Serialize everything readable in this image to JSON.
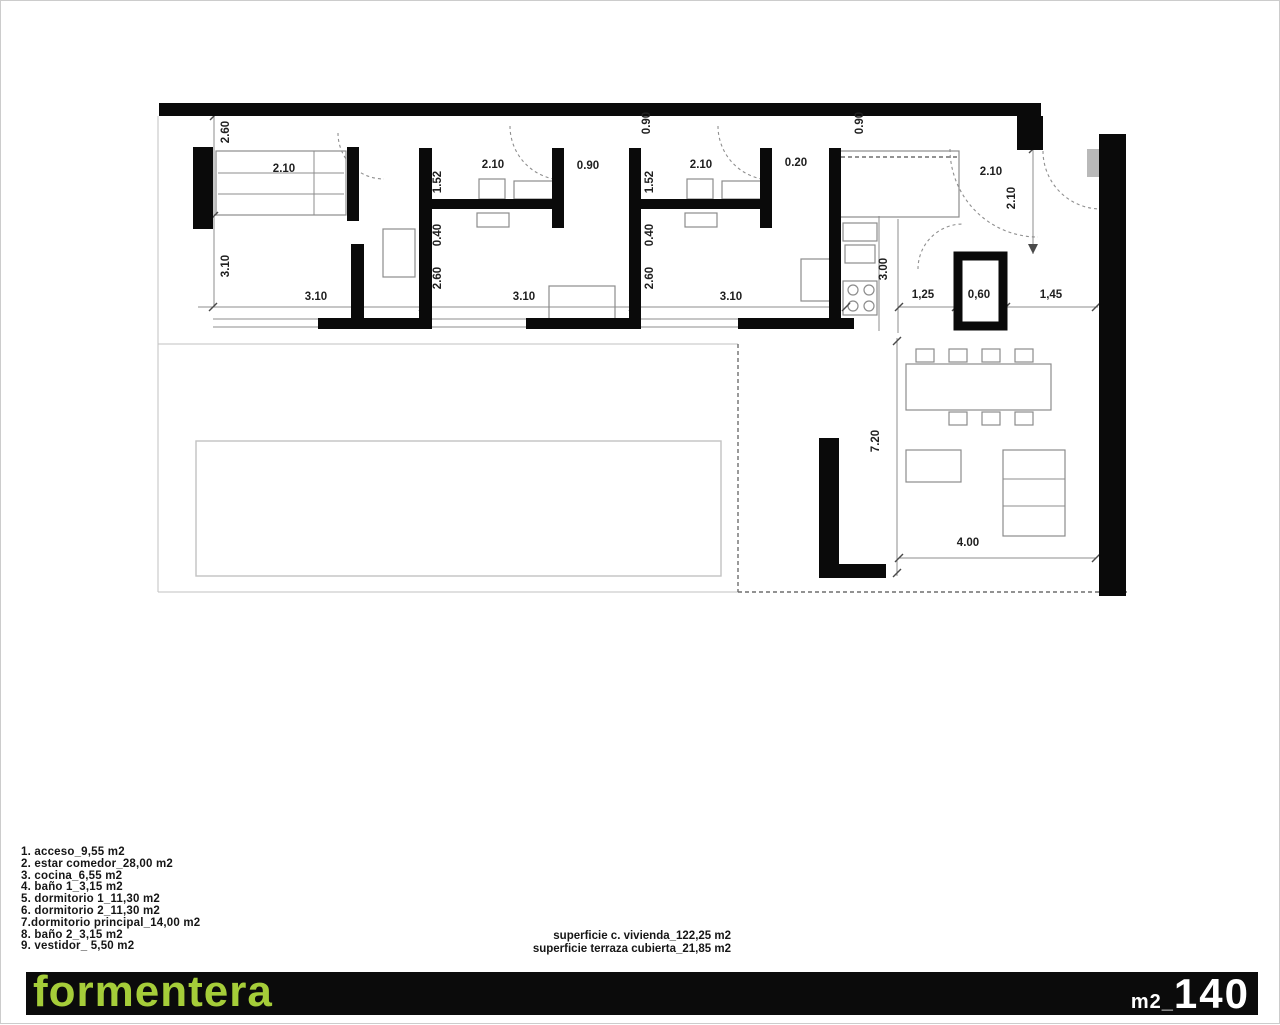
{
  "footer": {
    "brand": "formentera",
    "area_unit_label": "m2_",
    "area_value": "140",
    "bar_color": "#0b0b0b",
    "brand_color": "#a5cd39"
  },
  "legend": {
    "items": [
      "1. acceso_9,55 m2",
      "2. estar comedor_28,00 m2",
      "3. cocina_6,55 m2",
      "4. baño 1_3,15 m2",
      "5. dormitorio 1_11,30 m2",
      "6. dormitorio 2_11,30 m2",
      "7.dormitorio principal_14,00 m2",
      "8. baño 2_3,15 m2",
      "9. vestidor_ 5,50 m2"
    ]
  },
  "summary": {
    "line1": "superficie c. vivienda_122,25 m2",
    "line2": "superficie terraza cubierta_21,85 m2"
  },
  "plan": {
    "colors": {
      "wall": "#0a0a0a",
      "thin": "#8c8c8c",
      "light": "#c2c2c2",
      "dim_text": "#1f1f1f",
      "door_leaf": "#b9b9b9"
    },
    "walls": [
      [
        158,
        102,
        882,
        13
      ],
      [
        1016,
        115,
        26,
        34
      ],
      [
        1098,
        133,
        27,
        462
      ],
      [
        192,
        146,
        20,
        82
      ],
      [
        346,
        146,
        12,
        74
      ],
      [
        350,
        243,
        13,
        85
      ],
      [
        418,
        147,
        13,
        181
      ],
      [
        418,
        198,
        145,
        10
      ],
      [
        551,
        147,
        12,
        80
      ],
      [
        628,
        147,
        12,
        181
      ],
      [
        628,
        198,
        143,
        10
      ],
      [
        759,
        147,
        12,
        80
      ],
      [
        828,
        147,
        12,
        178
      ],
      [
        317,
        317,
        101,
        11
      ],
      [
        525,
        317,
        103,
        11
      ],
      [
        737,
        317,
        116,
        11
      ],
      [
        818,
        437,
        20,
        140
      ],
      [
        818,
        563,
        67,
        14
      ]
    ],
    "blocks": [
      [
        957,
        255,
        45,
        70
      ]
    ],
    "rects": [
      [
        215,
        150,
        130,
        64
      ],
      [
        478,
        178,
        26,
        20
      ],
      [
        513,
        180,
        40,
        18
      ],
      [
        476,
        212,
        32,
        14
      ],
      [
        686,
        178,
        26,
        20
      ],
      [
        721,
        180,
        40,
        18
      ],
      [
        684,
        212,
        32,
        14
      ],
      [
        382,
        228,
        32,
        48
      ],
      [
        548,
        285,
        66,
        38
      ],
      [
        800,
        258,
        33,
        42
      ],
      [
        838,
        150,
        120,
        66
      ],
      [
        842,
        222,
        34,
        18
      ],
      [
        844,
        244,
        30,
        18
      ],
      [
        842,
        280,
        34,
        34
      ],
      [
        905,
        363,
        145,
        46
      ],
      [
        915,
        348,
        18,
        13
      ],
      [
        948,
        348,
        18,
        13
      ],
      [
        981,
        348,
        18,
        13
      ],
      [
        1014,
        348,
        18,
        13
      ],
      [
        948,
        411,
        18,
        13
      ],
      [
        981,
        411,
        18,
        13
      ],
      [
        1014,
        411,
        18,
        13
      ],
      [
        905,
        449,
        55,
        32
      ],
      [
        1002,
        449,
        62,
        86
      ]
    ],
    "light_rects": [
      [
        195,
        440,
        525,
        135
      ]
    ],
    "lines": [
      [
        217,
        172,
        343,
        172
      ],
      [
        217,
        193,
        343,
        193
      ],
      [
        313,
        150,
        313,
        214
      ],
      [
        878,
        215,
        878,
        330
      ],
      [
        1002,
        478,
        1064,
        478
      ],
      [
        1002,
        505,
        1064,
        505
      ],
      [
        212,
        318,
        830,
        318
      ],
      [
        212,
        326,
        830,
        326
      ],
      [
        197,
        306,
        830,
        306
      ],
      [
        898,
        306,
        1097,
        306
      ],
      [
        213,
        115,
        213,
        306
      ],
      [
        1032,
        146,
        1032,
        253
      ],
      [
        896,
        337,
        896,
        575
      ],
      [
        898,
        557,
        1095,
        557
      ],
      [
        897,
        218,
        897,
        332
      ]
    ],
    "light_lines": [
      [
        157,
        115,
        157,
        591
      ],
      [
        157,
        591,
        737,
        591
      ],
      [
        157,
        343,
        737,
        343
      ]
    ],
    "dashed_lines": [
      [
        737,
        343,
        737,
        591
      ],
      [
        737,
        591,
        1128,
        591
      ],
      [
        840,
        156,
        956,
        156
      ]
    ],
    "arcs": [
      [
        337,
        132,
        383,
        178,
        46,
        0
      ],
      [
        509,
        125,
        563,
        179,
        54,
        0
      ],
      [
        717,
        125,
        771,
        179,
        54,
        0
      ],
      [
        917,
        268,
        962,
        223,
        45,
        1
      ],
      [
        949,
        148,
        1037,
        236,
        88,
        0
      ],
      [
        1042,
        150,
        1100,
        208,
        58,
        0
      ]
    ],
    "door_leafs": [
      [
        1086,
        148,
        13,
        28
      ]
    ],
    "circles": [
      [
        852,
        289,
        5
      ],
      [
        868,
        289,
        5
      ],
      [
        852,
        305,
        5
      ],
      [
        868,
        305,
        5
      ]
    ],
    "ticks": [
      [
        212,
        306
      ],
      [
        422,
        306
      ],
      [
        632,
        306
      ],
      [
        845,
        306
      ],
      [
        898,
        306
      ],
      [
        955,
        306
      ],
      [
        1005,
        306
      ],
      [
        1095,
        306
      ],
      [
        213,
        115
      ],
      [
        213,
        215
      ],
      [
        896,
        340
      ],
      [
        896,
        572
      ],
      [
        898,
        557
      ],
      [
        1095,
        557
      ],
      [
        1032,
        148
      ]
    ],
    "arrows": [
      [
        1032,
        253,
        1027,
        243,
        1037,
        243
      ]
    ],
    "dims": [
      {
        "t": "2.60",
        "x": 228,
        "y": 131,
        "r": 1
      },
      {
        "t": "2.10",
        "x": 283,
        "y": 171,
        "r": 0
      },
      {
        "t": "3.10",
        "x": 228,
        "y": 265,
        "r": 1
      },
      {
        "t": "3.10",
        "x": 315,
        "y": 299,
        "r": 0
      },
      {
        "t": "1.52",
        "x": 440,
        "y": 181,
        "r": 1
      },
      {
        "t": "2.10",
        "x": 492,
        "y": 167,
        "r": 0
      },
      {
        "t": "0.90",
        "x": 587,
        "y": 168,
        "r": 0
      },
      {
        "t": "0.90",
        "x": 649,
        "y": 122,
        "r": 1
      },
      {
        "t": "0.40",
        "x": 440,
        "y": 234,
        "r": 1
      },
      {
        "t": "2.60",
        "x": 440,
        "y": 277,
        "r": 1
      },
      {
        "t": "3.10",
        "x": 523,
        "y": 299,
        "r": 0
      },
      {
        "t": "1.52",
        "x": 652,
        "y": 181,
        "r": 1
      },
      {
        "t": "2.10",
        "x": 700,
        "y": 167,
        "r": 0
      },
      {
        "t": "0.20",
        "x": 795,
        "y": 165,
        "r": 0
      },
      {
        "t": "0.90",
        "x": 862,
        "y": 122,
        "r": 1
      },
      {
        "t": "0.40",
        "x": 652,
        "y": 234,
        "r": 1
      },
      {
        "t": "2.60",
        "x": 652,
        "y": 277,
        "r": 1
      },
      {
        "t": "3.10",
        "x": 730,
        "y": 299,
        "r": 0
      },
      {
        "t": "3.00",
        "x": 886,
        "y": 268,
        "r": 1
      },
      {
        "t": "2.10",
        "x": 990,
        "y": 174,
        "r": 0
      },
      {
        "t": "2.10",
        "x": 1014,
        "y": 197,
        "r": 1
      },
      {
        "t": "1,25",
        "x": 922,
        "y": 297,
        "r": 0
      },
      {
        "t": "0,60",
        "x": 978,
        "y": 297,
        "r": 0
      },
      {
        "t": "1,45",
        "x": 1050,
        "y": 297,
        "r": 0
      },
      {
        "t": "7.20",
        "x": 878,
        "y": 440,
        "r": 1
      },
      {
        "t": "4.00",
        "x": 967,
        "y": 545,
        "r": 0
      }
    ]
  }
}
